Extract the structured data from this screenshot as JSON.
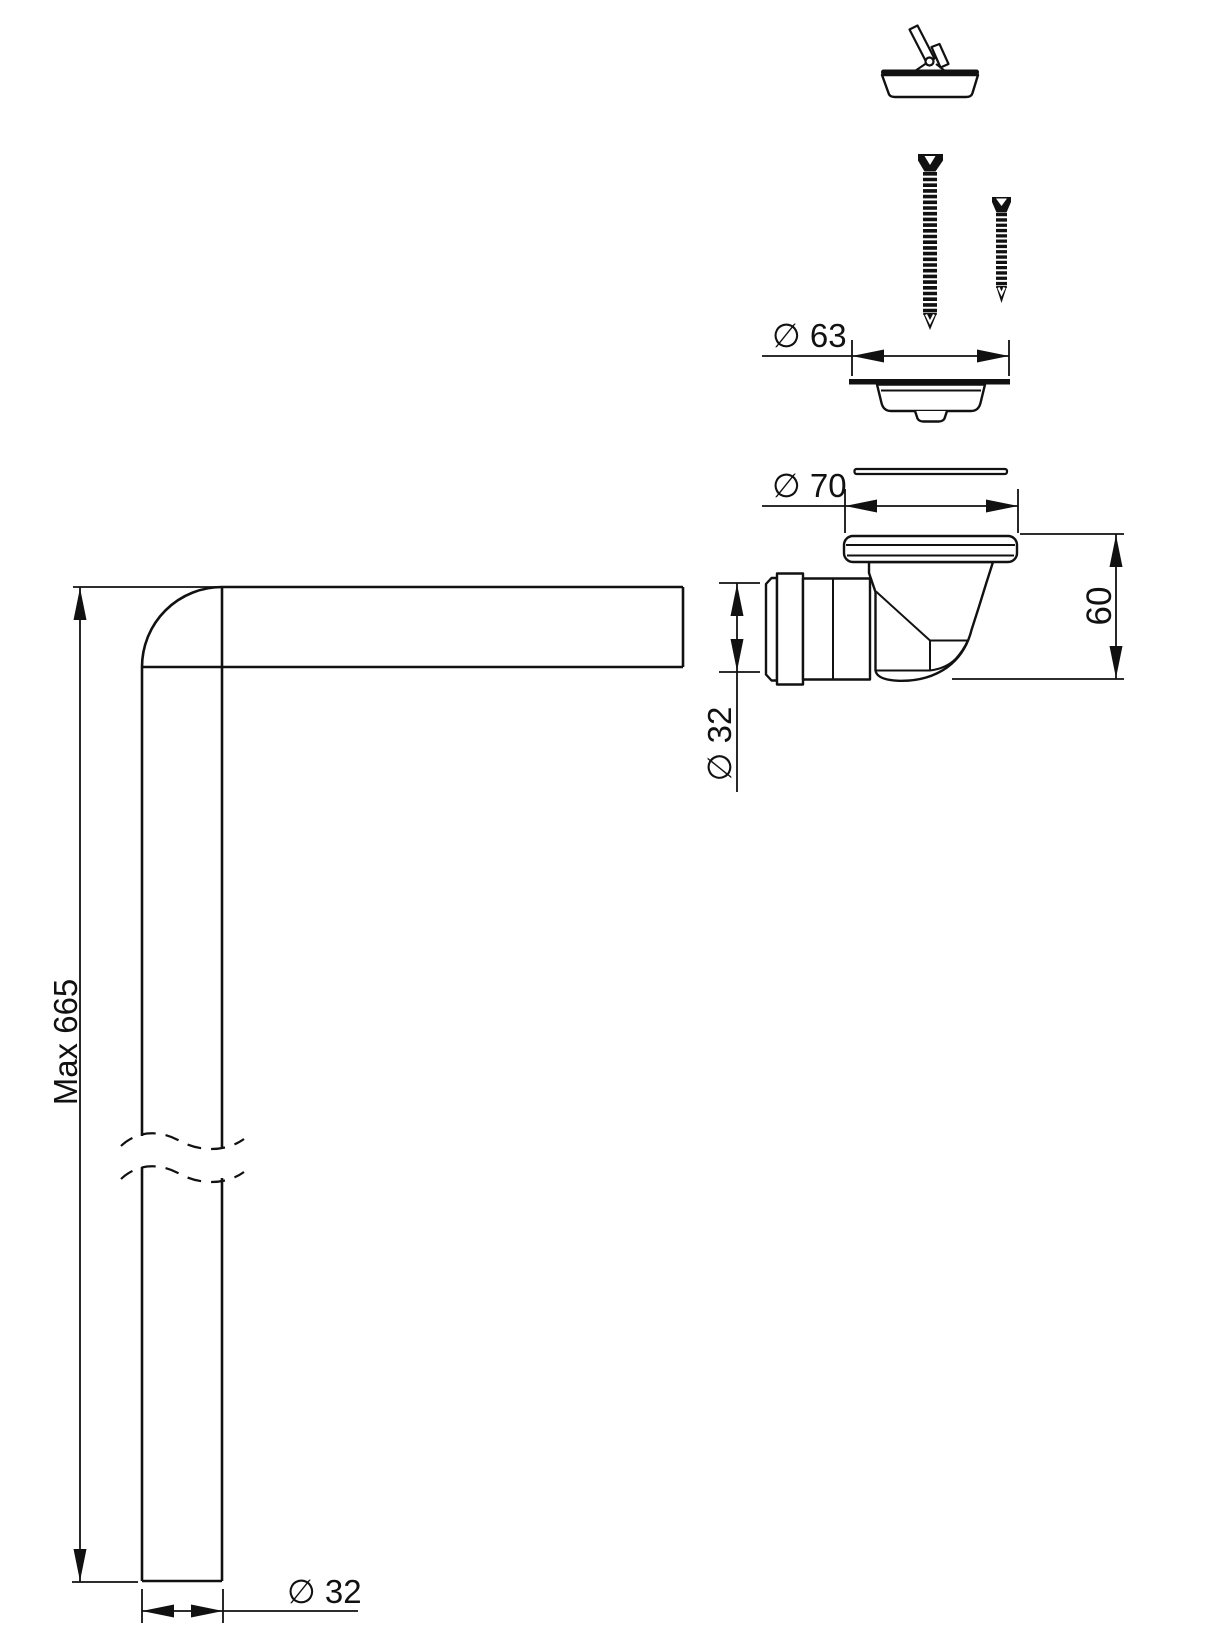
{
  "drawing": {
    "background": "#ffffff",
    "line_color": "#111111",
    "labels": {
      "strainer_diameter": "∅ 63",
      "fitting_diameter": "∅ 70",
      "fitting_height": "60",
      "inlet_diameter": "∅ 32",
      "pipe_max_length": "Max 665",
      "pipe_diameter": "∅ 32"
    }
  }
}
